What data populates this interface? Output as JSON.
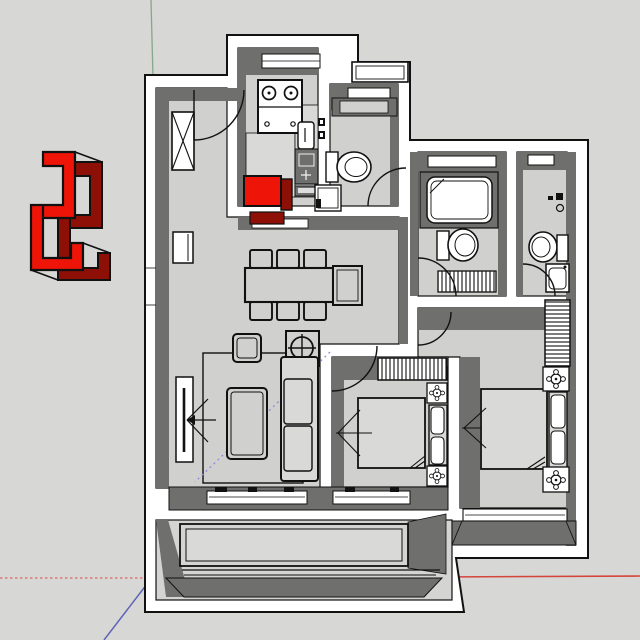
{
  "colors": {
    "background": "#d7d7d5",
    "floor": "#d0d0ce",
    "floor_bright": "#d9d9d7",
    "balcony": "#d4d4d2",
    "wall_top": "#ffffff",
    "wall_face": "#6f6f6d",
    "line": "#111111",
    "red_top": "#ee1407",
    "red_side": "#8e0f06",
    "axis_red": "#d4453c",
    "axis_green": "#86a886",
    "axis_blue": "#5d63b5",
    "inference": "#8e8ed8"
  },
  "viewport": {
    "type": "3d-modeling-viewport",
    "view": "top-down floor plan",
    "axes": {
      "green_axis": "vertical, top edge",
      "red_axis": "horizontal, solid to the right, dotted to the left",
      "blue_axis": "diagonal, lower-left"
    }
  },
  "component": {
    "name": "red-sculpted-component",
    "top_color": "#ee1407",
    "side_color": "#8e0f06"
  },
  "floorplan": {
    "rooms": [
      {
        "name": "entry",
        "items": [
          "entry-door",
          "shaft-box",
          "wall-radiator"
        ]
      },
      {
        "name": "kitchen",
        "items": [
          "window",
          "stove",
          "counter",
          "sink",
          "cutting-board",
          "red-box"
        ]
      },
      {
        "name": "bathroom-1",
        "items": [
          "window",
          "vanity",
          "taps",
          "toilet",
          "shower-tray",
          "door"
        ]
      },
      {
        "name": "dining",
        "items": [
          "dining-table",
          "chairs-x6",
          "side-table"
        ]
      },
      {
        "name": "living",
        "items": [
          "tv",
          "tv-view-arrow",
          "rug",
          "coffee-table",
          "pouf",
          "ceiling-lamp",
          "sofa",
          "window"
        ]
      },
      {
        "name": "bedroom-2",
        "items": [
          "wardrobe",
          "bed",
          "nightstand-x2",
          "door",
          "window"
        ]
      },
      {
        "name": "master-bedroom",
        "items": [
          "wardrobe",
          "bed",
          "nightstand-x2",
          "door",
          "window"
        ]
      },
      {
        "name": "bathroom-2",
        "items": [
          "window",
          "bathtub",
          "toilet",
          "towel-radiator",
          "door"
        ]
      },
      {
        "name": "bathroom-3",
        "items": [
          "window",
          "taps",
          "toilet",
          "washer",
          "door"
        ]
      },
      {
        "name": "balcony",
        "items": [
          "planter-box"
        ]
      }
    ]
  }
}
